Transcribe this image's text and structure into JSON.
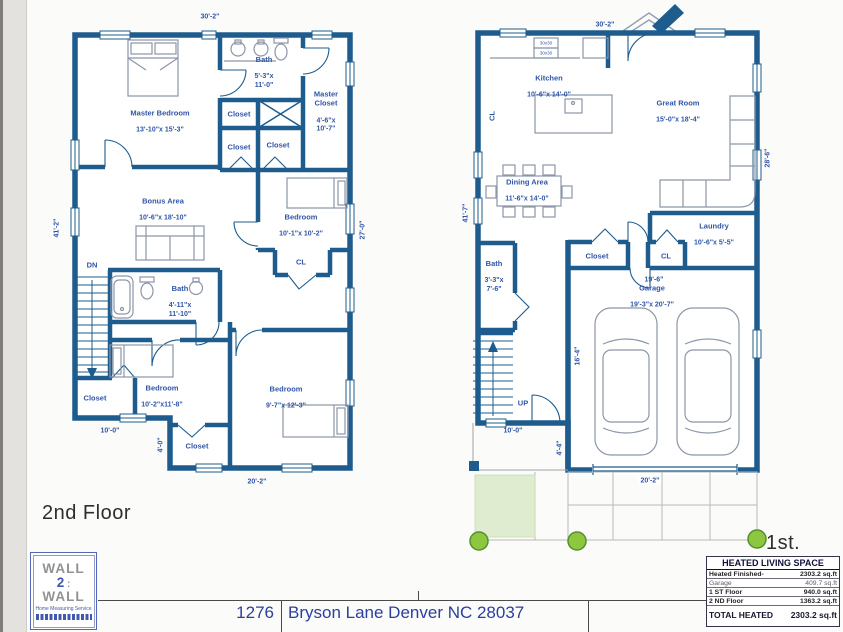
{
  "document": {
    "address_number": "1276",
    "address": "Bryson Lane Denver  NC 28037"
  },
  "floor2": {
    "title": "2nd Floor",
    "rooms": {
      "master_bedroom": {
        "name": "Master Bedroom",
        "dims": "13'-10\"x 15'-3\""
      },
      "bath_top": {
        "name": "Bath",
        "dims": "5'-3\"x\n11'-0\""
      },
      "master_closet": {
        "name": "Master\nCloset",
        "dims": "4'-6\"x\n10'-7\""
      },
      "closet_a": {
        "name": "Closet"
      },
      "closet_b": {
        "name": "Closet"
      },
      "closet_c": {
        "name": "Closet"
      },
      "bonus": {
        "name": "Bonus Area",
        "dims": "10'-6\"x 18'-10\""
      },
      "bedroom_ne": {
        "name": "Bedroom",
        "dims": "10'-1\"x 10'-2\""
      },
      "cl_ne": {
        "name": "CL"
      },
      "bath_mid": {
        "name": "Bath",
        "dims": "4'-11\"x\n11'-10\""
      },
      "stairs": {
        "name": "DN"
      },
      "bedroom_sw": {
        "name": "Bedroom",
        "dims": "10'-2\"x11'-8\""
      },
      "closet_sw": {
        "name": "Closet"
      },
      "bedroom_se": {
        "name": "Bedroom",
        "dims": "9'-7\"x 12'-3\""
      },
      "closet_s": {
        "name": "Closet"
      }
    },
    "dimensions": {
      "top": "30'-2\"",
      "left": "41'-2\"",
      "right": "27'-0\"",
      "bottom": "20'-2\"",
      "bottom_left": "10'-0\"",
      "step": "4'-0\""
    }
  },
  "floor1": {
    "title": "1st. Floor",
    "rooms": {
      "kitchen": {
        "name": "Kitchen",
        "dims": "10'-6\"x 14'-0\""
      },
      "cl_kitchen": {
        "name": "CL"
      },
      "great_room": {
        "name": "Great Room",
        "dims": "15'-0\"x 18'-4\""
      },
      "dining": {
        "name": "Dining Area",
        "dims": "11'-6\"x 14'-0\""
      },
      "laundry": {
        "name": "Laundry",
        "dims": "10'-6\"x 5'-5\""
      },
      "closet_hall": {
        "name": "Closet"
      },
      "cl_hall": {
        "name": "CL"
      },
      "bath": {
        "name": "Bath",
        "dims": "3'-3\"x\n7'-6\""
      },
      "garage": {
        "name": "Garage",
        "dims": "19'-3\"x 20'-7\""
      },
      "stairs": {
        "name": "UP"
      }
    },
    "appliances": {
      "range": "30x30",
      "oven": "30x30"
    },
    "dimensions": {
      "top": "30'-2\"",
      "left": "41'-7\"",
      "right": "28'-6\"",
      "hall": "19'-6\"",
      "entry": "10'-0\"",
      "step": "4'-4\"",
      "garage_side": "16'-4\"",
      "driveway": "20'-2\""
    }
  },
  "area_table": {
    "header": "HEATED LIVING SPACE",
    "rows": [
      {
        "label": "Heated Finished-",
        "value": "2303.2 sq.ft"
      },
      {
        "label": "Garage",
        "value": "409.7 sq.ft"
      },
      {
        "label": "1 ST Floor",
        "value": "940.0 sq.ft"
      },
      {
        "label": "2 ND Floor",
        "value": "1363.2 sq.ft"
      }
    ],
    "total": {
      "label": "TOTAL HEATED",
      "value": "2303.2 sq.ft"
    }
  },
  "logo": {
    "line1": "WALL",
    "line2": "2",
    "line3": "WALL",
    "tagline": "Home Measuring Service"
  },
  "colors": {
    "wall": "#1e5c8e",
    "text": "#2f55a8",
    "bush": "#8dc63f",
    "grass": "#dfeccf"
  }
}
